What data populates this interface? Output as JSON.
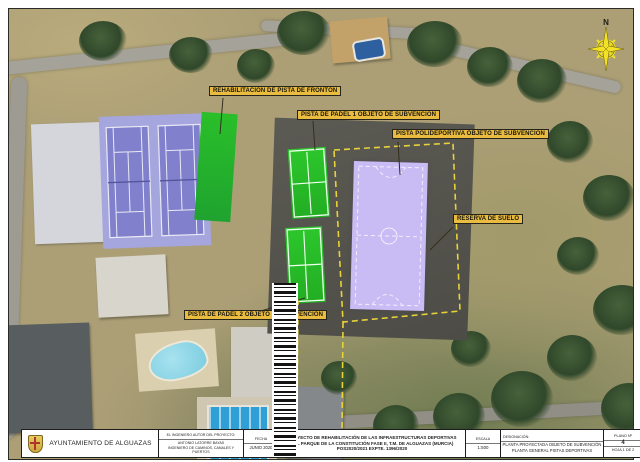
{
  "labels": {
    "fronton": "REHABILITACIÓN DE PISTA DE FRONTÓN",
    "padel1": "PISTA DE PADEL 1 OBJETO DE SUBVENCIÓN",
    "polideportiva": "PISTA POLIDEPORTIVA OBJETO DE SUBVENCIÓN",
    "reserva": "RESERVA DE SUELO",
    "padel2": "PISTA DE PADEL 2 OBJETO DE SUBVENCIÓN"
  },
  "compass": {
    "north_label": "N"
  },
  "title_block": {
    "client": "AYUNTAMIENTO DE ALGUAZAS",
    "engineer_heading": "EL INGENIERO AUTOR DEL PROYECTO:",
    "engineer_name": "ANTONIO LATORRE BAYAS",
    "engineer_title": "INGENIERO DE CAMINOS, CANALES Y PUERTOS",
    "date_heading": "FECHA",
    "date_value": "JUNIO 2020",
    "project_line1": "PROYECTO DE REHABILITACIÓN DE LAS INFRAESTRUCTURAS DEPORTIVAS",
    "project_line2": "DEL PARQUE DE LA CONSTITUCIÓN FASE II, T.M. DE ALGUAZAS (MURCIA)",
    "project_line3": "POS2020/2021 EXPTE. 1396/2020",
    "scale_heading": "ESCALA",
    "scale_value": "1:500",
    "designation_heading": "DESIGNACIÓN:",
    "designation_line1": "PLANTA PROYECTADA OBJETO DE SUBVENCIÓN",
    "designation_line2": "PLANTA GENERAL PISTAS DEPORTIVAS",
    "plan_no_heading": "PLANO Nº",
    "plan_no_value": "4",
    "sheet_value": "HOJA 1 DE 2"
  },
  "icons": {
    "compass": "compass-rose-icon",
    "crest": "alguazas-crest-icon",
    "barcode": "barcode-icon"
  },
  "colors": {
    "label_bg": "#e9bc3f",
    "court_green": "#2cc72c",
    "court_lavender": "#c9bcf5",
    "tennis_base": "#a6a6de",
    "tennis_surface": "#8080cc",
    "boundary_dashed_yellow": "#e8d23a",
    "compass_yellow": "#f2e126",
    "terrain_tan": "#ac9f76"
  }
}
